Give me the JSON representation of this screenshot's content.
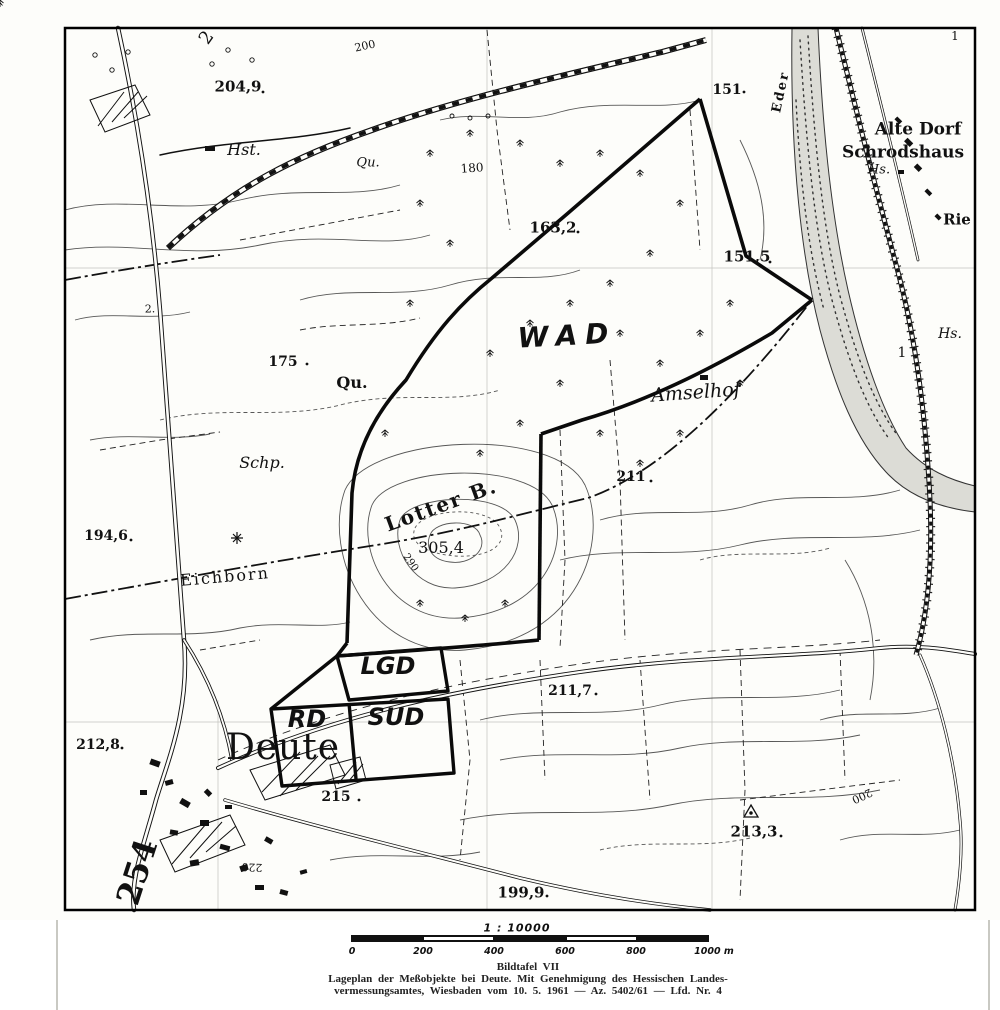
{
  "map": {
    "labels": [
      {
        "name": "spot-height-204-9",
        "text": "204,9"
      },
      {
        "name": "halt-hst",
        "text": "Hst."
      },
      {
        "name": "contour-200-top",
        "text": "200"
      },
      {
        "name": "spring-qu-upper",
        "text": "Qu."
      },
      {
        "name": "contour-180",
        "text": "180"
      },
      {
        "name": "spot-height-151",
        "text": "151"
      },
      {
        "name": "river-name-eder",
        "text": "Eder"
      },
      {
        "name": "place-alte-dorf",
        "text": "Alte Dorf"
      },
      {
        "name": "place-schrodshaus",
        "text": "Schrodshaus"
      },
      {
        "name": "house-hs-upper",
        "text": "Hs."
      },
      {
        "name": "place-rie",
        "text": "Rie"
      },
      {
        "name": "spot-height-163-2",
        "text": "163,2"
      },
      {
        "name": "spot-height-151-5",
        "text": "151,5"
      },
      {
        "name": "forest-wad",
        "text": "WAD"
      },
      {
        "name": "spot-height-175",
        "text": "175"
      },
      {
        "name": "spring-qu",
        "text": "Qu."
      },
      {
        "name": "place-amselhof",
        "text": "Amselhof"
      },
      {
        "name": "house-hs-right",
        "text": "Hs."
      },
      {
        "name": "number-1-right",
        "text": "1"
      },
      {
        "name": "number-1-top-right",
        "text": "1"
      },
      {
        "name": "number-2-top-left",
        "text": "2"
      },
      {
        "name": "place-schp",
        "text": "Schp."
      },
      {
        "name": "hill-lotter-b",
        "text": "Lotter B."
      },
      {
        "name": "spot-height-305-4",
        "text": "305,4"
      },
      {
        "name": "contour-290",
        "text": "290"
      },
      {
        "name": "spot-height-211",
        "text": "211"
      },
      {
        "name": "spot-height-194-6",
        "text": "194,6"
      },
      {
        "name": "place-eichborn",
        "text": "Eichborn"
      },
      {
        "name": "number-2-left",
        "text": "2."
      },
      {
        "name": "spot-height-212-8",
        "text": "212,8"
      },
      {
        "name": "place-deute",
        "text": "Deute"
      },
      {
        "name": "survey-object-lgd",
        "text": "LGD"
      },
      {
        "name": "survey-object-rd",
        "text": "RD"
      },
      {
        "name": "survey-object-sud",
        "text": "SUD"
      },
      {
        "name": "spot-height-215",
        "text": "215"
      },
      {
        "name": "spot-height-211-7",
        "text": "211,7"
      },
      {
        "name": "spot-height-213-3",
        "text": "213,3"
      },
      {
        "name": "spot-height-199-9",
        "text": "199,9"
      },
      {
        "name": "contour-220",
        "text": "220"
      },
      {
        "name": "road-number-254",
        "text": "254"
      },
      {
        "name": "contour-200-right",
        "text": "200"
      }
    ]
  },
  "scale": {
    "ratio": "1 : 10000",
    "ticks": [
      "0",
      "200",
      "400",
      "600",
      "800"
    ],
    "end_label": "1000 m"
  },
  "caption": {
    "line1": "Bildtafel VII",
    "line2": "Lageplan der Meßobjekte bei Deute. Mit Genehmigung des Hessischen Landes-",
    "line3": "vermessungsamtes, Wiesbaden vom 10. 5. 1961 — Az. 5402/61 — Lfd. Nr. 4"
  },
  "colors": {
    "ink": "#1a1a1a",
    "paper": "#fdfdfa",
    "river_fill": "#dcdcd6"
  }
}
